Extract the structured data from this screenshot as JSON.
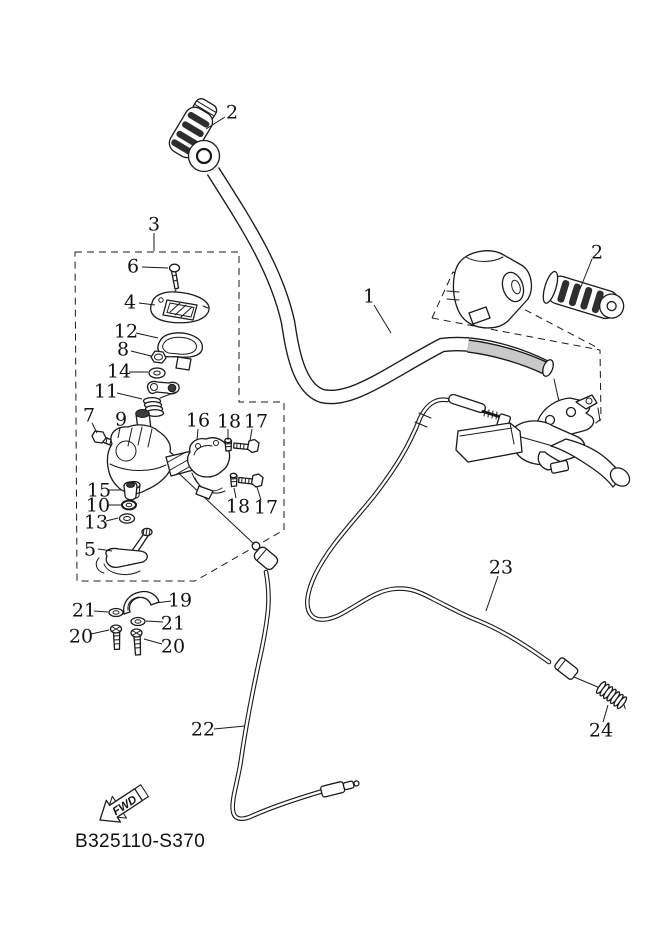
{
  "diagram": {
    "code_label": "B325110-S370",
    "fwd_label": "FWD",
    "colors": {
      "line": "#1a1a1a",
      "background": "#ffffff",
      "grip_band": "#2e2e2e",
      "bar_clamp_gray": "#c9c9c9"
    },
    "callouts": [
      {
        "id": "1",
        "label": "1",
        "x": 369,
        "y": 296,
        "x1": 374,
        "y1": 305,
        "x2": 391,
        "y2": 333
      },
      {
        "id": "2-left",
        "label": "2",
        "x": 232,
        "y": 112,
        "x1": 225,
        "y1": 117,
        "x2": 206,
        "y2": 129
      },
      {
        "id": "2-right",
        "label": "2",
        "x": 597,
        "y": 252,
        "x1": 592,
        "y1": 259,
        "x2": 580,
        "y2": 289
      },
      {
        "id": "3",
        "label": "3",
        "x": 154,
        "y": 224,
        "x1": 154,
        "y1": 233,
        "x2": 154,
        "y2": 251
      },
      {
        "id": "4",
        "label": "4",
        "x": 130,
        "y": 302,
        "x1": 139,
        "y1": 303,
        "x2": 155,
        "y2": 305
      },
      {
        "id": "5",
        "label": "5",
        "x": 90,
        "y": 549,
        "x1": 98,
        "y1": 549,
        "x2": 112,
        "y2": 551
      },
      {
        "id": "6",
        "label": "6",
        "x": 133,
        "y": 266,
        "x1": 142,
        "y1": 267,
        "x2": 168,
        "y2": 268
      },
      {
        "id": "7",
        "label": "7",
        "x": 89,
        "y": 415,
        "x1": 92,
        "y1": 423,
        "x2": 97,
        "y2": 433
      },
      {
        "id": "8",
        "label": "8",
        "x": 123,
        "y": 349,
        "x1": 131,
        "y1": 351,
        "x2": 151,
        "y2": 356
      },
      {
        "id": "9",
        "label": "9",
        "x": 121,
        "y": 419,
        "x1": 120,
        "y1": 428,
        "x2": 118,
        "y2": 438
      },
      {
        "id": "10",
        "label": "10",
        "x": 98,
        "y": 505,
        "x1": 108,
        "y1": 505,
        "x2": 121,
        "y2": 505
      },
      {
        "id": "11",
        "label": "11",
        "x": 106,
        "y": 391,
        "x1": 117,
        "y1": 393,
        "x2": 142,
        "y2": 399
      },
      {
        "id": "12",
        "label": "12",
        "x": 126,
        "y": 331,
        "x1": 136,
        "y1": 333,
        "x2": 158,
        "y2": 338
      },
      {
        "id": "13",
        "label": "13",
        "x": 96,
        "y": 522,
        "x1": 106,
        "y1": 521,
        "x2": 118,
        "y2": 518
      },
      {
        "id": "14",
        "label": "14",
        "x": 119,
        "y": 371,
        "x1": 129,
        "y1": 372,
        "x2": 148,
        "y2": 372
      },
      {
        "id": "15",
        "label": "15",
        "x": 99,
        "y": 490,
        "x1": 108,
        "y1": 490,
        "x2": 122,
        "y2": 490
      },
      {
        "id": "16",
        "label": "16",
        "x": 198,
        "y": 420,
        "x1": 198,
        "y1": 429,
        "x2": 197,
        "y2": 440
      },
      {
        "id": "17-upper",
        "label": "17",
        "x": 256,
        "y": 421,
        "x1": 252,
        "y1": 429,
        "x2": 250,
        "y2": 441
      },
      {
        "id": "18-upper",
        "label": "18",
        "x": 229,
        "y": 421,
        "x1": 228,
        "y1": 429,
        "x2": 228,
        "y2": 440
      },
      {
        "id": "17-lower",
        "label": "17",
        "x": 266,
        "y": 507,
        "x1": 261,
        "y1": 500,
        "x2": 257,
        "y2": 487
      },
      {
        "id": "18-lower",
        "label": "18",
        "x": 238,
        "y": 506,
        "x1": 236,
        "y1": 498,
        "x2": 234,
        "y2": 488
      },
      {
        "id": "19",
        "label": "19",
        "x": 180,
        "y": 600,
        "x1": 171,
        "y1": 601,
        "x2": 156,
        "y2": 603
      },
      {
        "id": "20-left",
        "label": "20",
        "x": 81,
        "y": 636,
        "x1": 91,
        "y1": 634,
        "x2": 109,
        "y2": 630
      },
      {
        "id": "20-right",
        "label": "20",
        "x": 173,
        "y": 646,
        "x1": 162,
        "y1": 644,
        "x2": 144,
        "y2": 639
      },
      {
        "id": "21-left",
        "label": "21",
        "x": 84,
        "y": 610,
        "x1": 94,
        "y1": 611,
        "x2": 108,
        "y2": 612
      },
      {
        "id": "21-right",
        "label": "21",
        "x": 173,
        "y": 623,
        "x1": 163,
        "y1": 622,
        "x2": 146,
        "y2": 621
      },
      {
        "id": "22",
        "label": "22",
        "x": 203,
        "y": 729,
        "x1": 214,
        "y1": 729,
        "x2": 245,
        "y2": 726
      },
      {
        "id": "23",
        "label": "23",
        "x": 501,
        "y": 567,
        "x1": 498,
        "y1": 576,
        "x2": 486,
        "y2": 611
      },
      {
        "id": "24",
        "label": "24",
        "x": 601,
        "y": 730,
        "x1": 603,
        "y1": 722,
        "x2": 608,
        "y2": 705
      }
    ]
  }
}
